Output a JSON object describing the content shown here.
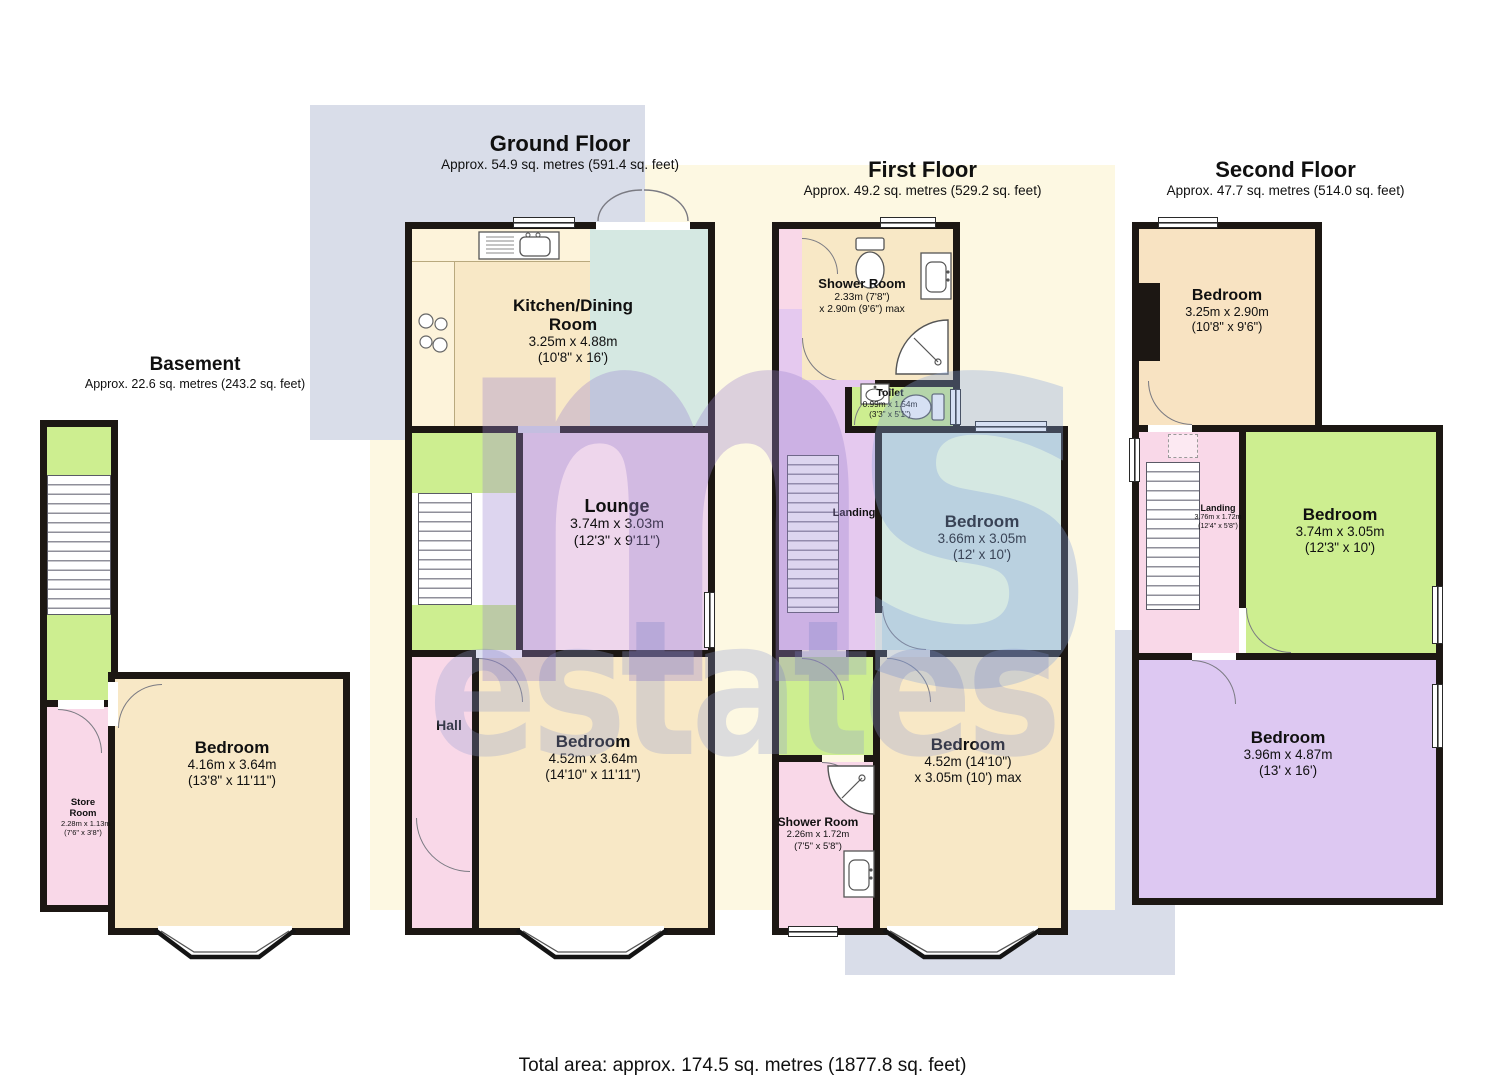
{
  "watermark": {
    "m": "m",
    "s": "s",
    "word": "estates"
  },
  "footer": {
    "total_area": "Total area: approx. 174.5 sq. metres (1877.8 sq. feet)"
  },
  "colors": {
    "cream": "#f8e8c6",
    "counter": "#fdf3da",
    "teal": "#d5e8e2",
    "pink": "#f9d8e8",
    "lilac": "#e5c9ef",
    "lounge": "#eed6ec",
    "green": "#cdee90",
    "purple": "#ddc8f2",
    "peach": "#f8e3c2",
    "wall": "#1c1713",
    "creambg": "#fdf8e2",
    "greybg": "#d9dde9",
    "wmm": "#9b84cf",
    "wms": "#86a2dc",
    "wmword": "#8f9ccf"
  },
  "floors": {
    "basement": {
      "title": "Basement",
      "subtitle": "Approx. 22.6 sq. metres (243.2 sq. feet)",
      "rooms": {
        "bedroom": {
          "name": "Bedroom",
          "dim1": "4.16m x 3.64m",
          "dim2": "(13'8\" x 11'11\")"
        },
        "store": {
          "name": "Store Room",
          "dim1": "2.28m x 1.13m",
          "dim2": "(7'6\" x 3'8\")"
        }
      }
    },
    "ground": {
      "title": "Ground Floor",
      "subtitle": "Approx. 54.9 sq. metres (591.4 sq. feet)",
      "rooms": {
        "kitchen": {
          "name": "Kitchen/Dining Room",
          "dim1": "3.25m x 4.88m",
          "dim2": "(10'8\" x 16')"
        },
        "lounge": {
          "name": "Lounge",
          "dim1": "3.74m x 3.03m",
          "dim2": "(12'3\" x 9'11\")"
        },
        "hall": {
          "name": "Hall"
        },
        "bedroom": {
          "name": "Bedroom",
          "dim1": "4.52m x 3.64m",
          "dim2": "(14'10\" x 11'11\")"
        }
      }
    },
    "first": {
      "title": "First Floor",
      "subtitle": "Approx. 49.2 sq. metres (529.2 sq. feet)",
      "rooms": {
        "shower1": {
          "name": "Shower Room",
          "dim1": "2.33m (7'8\")",
          "dim2": "x 2.90m (9'6\") max"
        },
        "toilet": {
          "name": "Toilet",
          "dim1": "0.99m x 1.54m",
          "dim2": "(3'3\" x 5'1\")"
        },
        "landing": {
          "name": "Landing"
        },
        "bedroom1": {
          "name": "Bedroom",
          "dim1": "3.66m x 3.05m",
          "dim2": "(12' x 10')"
        },
        "bedroom2": {
          "name": "Bedroom",
          "dim1": "4.52m (14'10\")",
          "dim2": "x 3.05m (10') max"
        },
        "shower2": {
          "name": "Shower Room",
          "dim1": "2.26m x 1.72m",
          "dim2": "(7'5\" x 5'8\")"
        }
      }
    },
    "second": {
      "title": "Second Floor",
      "subtitle": "Approx. 47.7 sq. metres (514.0 sq. feet)",
      "rooms": {
        "bedroom1": {
          "name": "Bedroom",
          "dim1": "3.25m x 2.90m",
          "dim2": "(10'8\" x 9'6\")"
        },
        "landing": {
          "name": "Landing",
          "dim1": "3.76m x 1.72m",
          "dim2": "(12'4\" x 5'8\")"
        },
        "bedroom2": {
          "name": "Bedroom",
          "dim1": "3.74m x 3.05m",
          "dim2": "(12'3\" x 10')"
        },
        "bedroom3": {
          "name": "Bedroom",
          "dim1": "3.96m x 4.87m",
          "dim2": "(13' x 16')"
        }
      }
    }
  }
}
